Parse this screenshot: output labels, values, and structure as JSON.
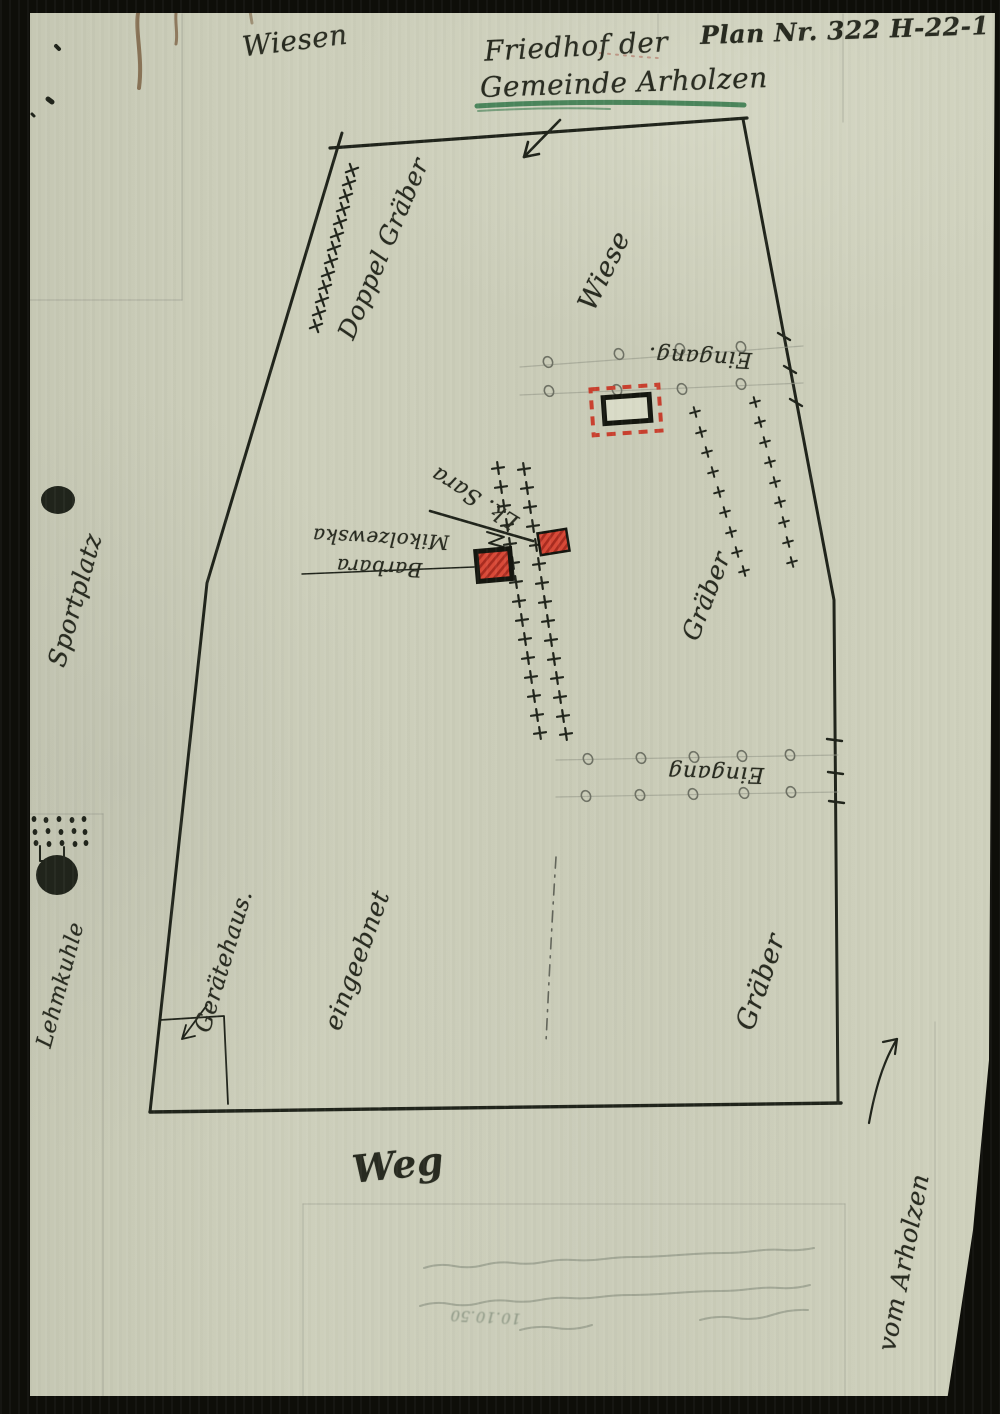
{
  "header": {
    "plan_no": "Plan Nr. 322 H-22-1",
    "title_line1": "Friedhof der",
    "title_line2": "Gemeinde Arholzen"
  },
  "labels": {
    "wiesen": "Wiesen",
    "doppel_graeber": "Doppel Gräber",
    "wiese": "Wiese",
    "eingang_top": "Eingang.",
    "eingang_bottom": "Eingang",
    "graeber_right": "Gräber",
    "graeber_lower": "Gräber",
    "grave1_line1": "Barbara",
    "grave1_line2": "Mikolzewska",
    "grave2": "Lk. Sara",
    "eingeebnet": "eingeebnet",
    "geraetehaus": "Gerätehaus.",
    "sportplatz": "Sportplatz",
    "lehmkuhle": "Lehmkuhle",
    "weg": "Weg",
    "vom_arholzen": "vom Arholzen",
    "faint_note_date": "10.10.50"
  },
  "colors": {
    "paper": "#cbcdb9",
    "ink": "#20241b",
    "pencil": "#9a9c8d",
    "red": "#c9402f",
    "green_underline": "#3c7c50",
    "stain": "#6e4f2e"
  },
  "map": {
    "ink": "#20241b",
    "pencil": "#9a9c8d",
    "paths": [
      {
        "d": "M330,148 L747,118",
        "w": 3.2
      },
      {
        "d": "M743,119 L834,600 L838,1103",
        "w": 3
      },
      {
        "d": "M841,1103 L150,1112",
        "w": 3.4
      },
      {
        "d": "M150,1112 L207,583 L342,133",
        "w": 3
      },
      {
        "d": "M560,120 L524,157",
        "w": 2.6
      },
      {
        "d": "M524,157 l15,-3 M524,157 l4,-15",
        "w": 2.6
      },
      {
        "d": "M302,574 L474,567",
        "w": 1.5
      },
      {
        "d": "M430,511 L533,541",
        "w": 2.6
      },
      {
        "d": "M487,532 l17,5 -15,6 18,5",
        "w": 2
      },
      {
        "d": "M613,405 l9,4 m5,1 l9,3",
        "w": 1.5,
        "o": 0.8
      },
      {
        "d": "M160,1020 L224,1016 L228,1104",
        "w": 1.8
      },
      {
        "d": "M207,1005 L182,1039",
        "w": 1.8
      },
      {
        "d": "M182,1039 l4,-14 M182,1039 l13,-3",
        "w": 1.8
      },
      {
        "d": "M869,1123 C875,1090 883,1062 897,1039",
        "w": 2.2
      },
      {
        "d": "M897,1039 l-14,3 M897,1039 l-2,15",
        "w": 2.2
      },
      {
        "d": "M520,367 L803,346",
        "c": "#9a9c8d",
        "w": 1.2,
        "o": 0.65
      },
      {
        "d": "M520,395 L803,383",
        "c": "#9a9c8d",
        "w": 1.2,
        "o": 0.65
      },
      {
        "d": "M556,760 L838,755",
        "c": "#9a9c8d",
        "w": 1.2,
        "o": 0.65
      },
      {
        "d": "M556,797 L838,792",
        "c": "#9a9c8d",
        "w": 1.2,
        "o": 0.65
      },
      {
        "d": "M778,333 l12,7",
        "w": 2.4
      },
      {
        "d": "M784,366 l12,7",
        "w": 2.4
      },
      {
        "d": "M790,399 l12,7",
        "w": 2.4
      },
      {
        "d": "M827,739 l15,2",
        "w": 2.4
      },
      {
        "d": "M828,772 l15,2",
        "w": 2.4
      },
      {
        "d": "M829,801 l15,2",
        "w": 2.4
      },
      {
        "d": "M556,857 C552,920 549,980 546,1042",
        "c": "#51544a",
        "w": 1.6,
        "dash": "11 7 2 7",
        "o": 0.85
      },
      {
        "d": "M182,14 V300",
        "c": "#9a9c8d",
        "w": 1.2,
        "o": 0.5
      },
      {
        "d": "M30,300 H182",
        "c": "#9a9c8d",
        "w": 1.2,
        "o": 0.5
      },
      {
        "d": "M843,14 V122",
        "c": "#9a9c8d",
        "w": 1.2,
        "o": 0.5
      },
      {
        "d": "M658,14 V42",
        "c": "#9a9c8d",
        "w": 1.2,
        "o": 0.5
      },
      {
        "d": "M30,814 H103",
        "c": "#9a9c8d",
        "w": 1.2,
        "o": 0.5
      },
      {
        "d": "M103,814 V1396",
        "c": "#9a9c8d",
        "w": 1.2,
        "o": 0.45
      },
      {
        "d": "M303,1204 V1396",
        "c": "#9a9c8d",
        "w": 1.2,
        "o": 0.45
      },
      {
        "d": "M303,1204 H845",
        "c": "#9a9c8d",
        "w": 1.2,
        "o": 0.45
      },
      {
        "d": "M845,1204 V1396",
        "c": "#9a9c8d",
        "w": 1.2,
        "o": 0.45
      },
      {
        "d": "M935,1022 V1396",
        "c": "#9a9c8d",
        "w": 1.2,
        "o": 0.45
      },
      {
        "d": "M477,106 C560,101 660,102 744,105",
        "c": "#3c7c50",
        "w": 5,
        "o": 0.9
      },
      {
        "d": "M478,111 C530,108 580,108 610,109",
        "c": "#3c7c50",
        "w": 2,
        "o": 0.6
      },
      {
        "d": "M600,53 C620,55 640,57 658,58",
        "c": "#b07060",
        "w": 2,
        "dash": "2 6",
        "o": 0.6
      },
      {
        "d": "M138,13 C135,32 143,58 139,88",
        "c": "#6e4f2e",
        "w": 4,
        "o": 0.7
      },
      {
        "d": "M176,13 C175,24 178,34 176,44",
        "c": "#6e4f2e",
        "w": 3,
        "o": 0.65
      },
      {
        "d": "M250,11 L252,23",
        "c": "#6e4f2e",
        "w": 3,
        "o": 0.5
      },
      {
        "d": "M56,46 l3,3",
        "w": 4
      },
      {
        "d": "M48,99 l4,3",
        "w": 5
      },
      {
        "d": "M32,114 l2,2",
        "w": 3
      },
      {
        "d": "M40,846 V861 H64 V847",
        "w": 2
      },
      {
        "d": "M52,862 L55,871",
        "w": 2
      },
      {
        "d": "M424,1268 q15,-5 30,-2 t30,-1 t30,-2 t30,-1 t30,-2 t30,-1 t30,-2 t30,-1 t30,-2 t30,-1 t30,-2 t30,-1 t30,-2",
        "c": "#798272",
        "w": 2,
        "o": 0.5
      },
      {
        "d": "M420,1306 q15,-5 30,-2 t30,-1 t30,-2 t30,-1 t30,-2 t30,-1 t30,-2 t30,-1 t30,-2 t30,-1 t30,-2 t30,-1 t30,-3",
        "c": "#798272",
        "w": 2,
        "o": 0.5
      },
      {
        "d": "M520,1330 q18,-5 36,-2 t36,-3",
        "c": "#798272",
        "w": 2,
        "o": 0.5
      },
      {
        "d": "M700,1320 q18,-5 36,-2 t36,-3 t36,-5",
        "c": "#798272",
        "w": 2,
        "o": 0.5
      }
    ],
    "crosses": [
      {
        "s": 6.5,
        "w": 2.2,
        "r": -20,
        "pts": [
          [
            352,
            170
          ],
          [
            349,
            183
          ],
          [
            346,
            196
          ],
          [
            343,
            209
          ],
          [
            340,
            222
          ],
          [
            337,
            235
          ],
          [
            334,
            248
          ],
          [
            331,
            261
          ],
          [
            328,
            274
          ],
          [
            325,
            287
          ],
          [
            322,
            300
          ],
          [
            319,
            313
          ],
          [
            316,
            326
          ]
        ]
      },
      {
        "s": 5,
        "w": 2,
        "r": -15,
        "pts": [
          [
            695,
            412
          ],
          [
            701,
            432
          ],
          [
            707,
            452
          ],
          [
            713,
            472
          ],
          [
            719,
            492
          ],
          [
            725,
            512
          ],
          [
            731,
            532
          ],
          [
            737,
            552
          ],
          [
            744,
            571
          ]
        ]
      },
      {
        "s": 5,
        "w": 2,
        "r": -15,
        "pts": [
          [
            755,
            402
          ],
          [
            760,
            422
          ],
          [
            765,
            442
          ],
          [
            770,
            462
          ],
          [
            775,
            482
          ],
          [
            780,
            502
          ],
          [
            784,
            522
          ],
          [
            788,
            542
          ],
          [
            792,
            562
          ]
        ]
      },
      {
        "s": 6,
        "w": 2.2,
        "r": -8,
        "pts": [
          [
            498,
            468
          ],
          [
            501,
            487
          ],
          [
            504,
            506
          ],
          [
            507,
            525
          ],
          [
            510,
            544
          ],
          [
            513,
            563
          ],
          [
            516,
            582
          ],
          [
            519,
            601
          ],
          [
            522,
            620
          ],
          [
            525,
            639
          ],
          [
            528,
            658
          ],
          [
            531,
            677
          ],
          [
            534,
            696
          ],
          [
            537,
            715
          ],
          [
            540,
            733
          ]
        ]
      },
      {
        "s": 6,
        "w": 2.2,
        "r": -8,
        "pts": [
          [
            524,
            469
          ],
          [
            527,
            488
          ],
          [
            530,
            507
          ],
          [
            533,
            526
          ],
          [
            536,
            545
          ],
          [
            539,
            564
          ],
          [
            542,
            583
          ],
          [
            545,
            602
          ],
          [
            548,
            621
          ],
          [
            551,
            640
          ],
          [
            554,
            659
          ],
          [
            557,
            678
          ],
          [
            560,
            697
          ],
          [
            563,
            716
          ],
          [
            566,
            734
          ]
        ]
      }
    ],
    "circles": [
      {
        "rx": 4.5,
        "ry": 5.5,
        "r": -24,
        "c": "#6f7265",
        "w": 1.6,
        "pts": [
          [
            548,
            362
          ],
          [
            619,
            354
          ],
          [
            680,
            349
          ],
          [
            741,
            347
          ],
          [
            549,
            391
          ],
          [
            617,
            390
          ],
          [
            682,
            389
          ],
          [
            741,
            384
          ],
          [
            588,
            759
          ],
          [
            641,
            758
          ],
          [
            694,
            757
          ],
          [
            742,
            756
          ],
          [
            790,
            755
          ],
          [
            586,
            796
          ],
          [
            640,
            795
          ],
          [
            693,
            794
          ],
          [
            744,
            793
          ],
          [
            791,
            792
          ]
        ]
      }
    ],
    "dots": [
      [
        23,
        819
      ],
      [
        34,
        819
      ],
      [
        46,
        820
      ],
      [
        59,
        819
      ],
      [
        72,
        820
      ],
      [
        84,
        819
      ],
      [
        23,
        831
      ],
      [
        35,
        832
      ],
      [
        48,
        831
      ],
      [
        61,
        832
      ],
      [
        74,
        831
      ],
      [
        85,
        832
      ],
      [
        24,
        843
      ],
      [
        36,
        843
      ],
      [
        49,
        844
      ],
      [
        62,
        843
      ],
      [
        75,
        844
      ],
      [
        86,
        843
      ]
    ],
    "blobs": [
      [
        58,
        500,
        17,
        14
      ],
      [
        57,
        875,
        21,
        20
      ]
    ],
    "rects": [
      {
        "x": 592,
        "y": 387,
        "w": 68,
        "h": 46,
        "rot": -4,
        "c": "#c9402f",
        "sw": 4,
        "dash": "9 7"
      },
      {
        "x": 604,
        "y": 396,
        "w": 46,
        "h": 26,
        "rot": -4,
        "c": "#14160f",
        "sw": 5,
        "f": "#d9dbc7"
      },
      {
        "x": 477,
        "y": 550,
        "w": 34,
        "h": 30,
        "rot": -5,
        "c": "#14160f",
        "sw": 5,
        "f": "hatch"
      },
      {
        "x": 539,
        "y": 531,
        "w": 29,
        "h": 22,
        "rot": -9,
        "c": "#14160f",
        "sw": 2.5,
        "f": "hatch"
      }
    ]
  }
}
